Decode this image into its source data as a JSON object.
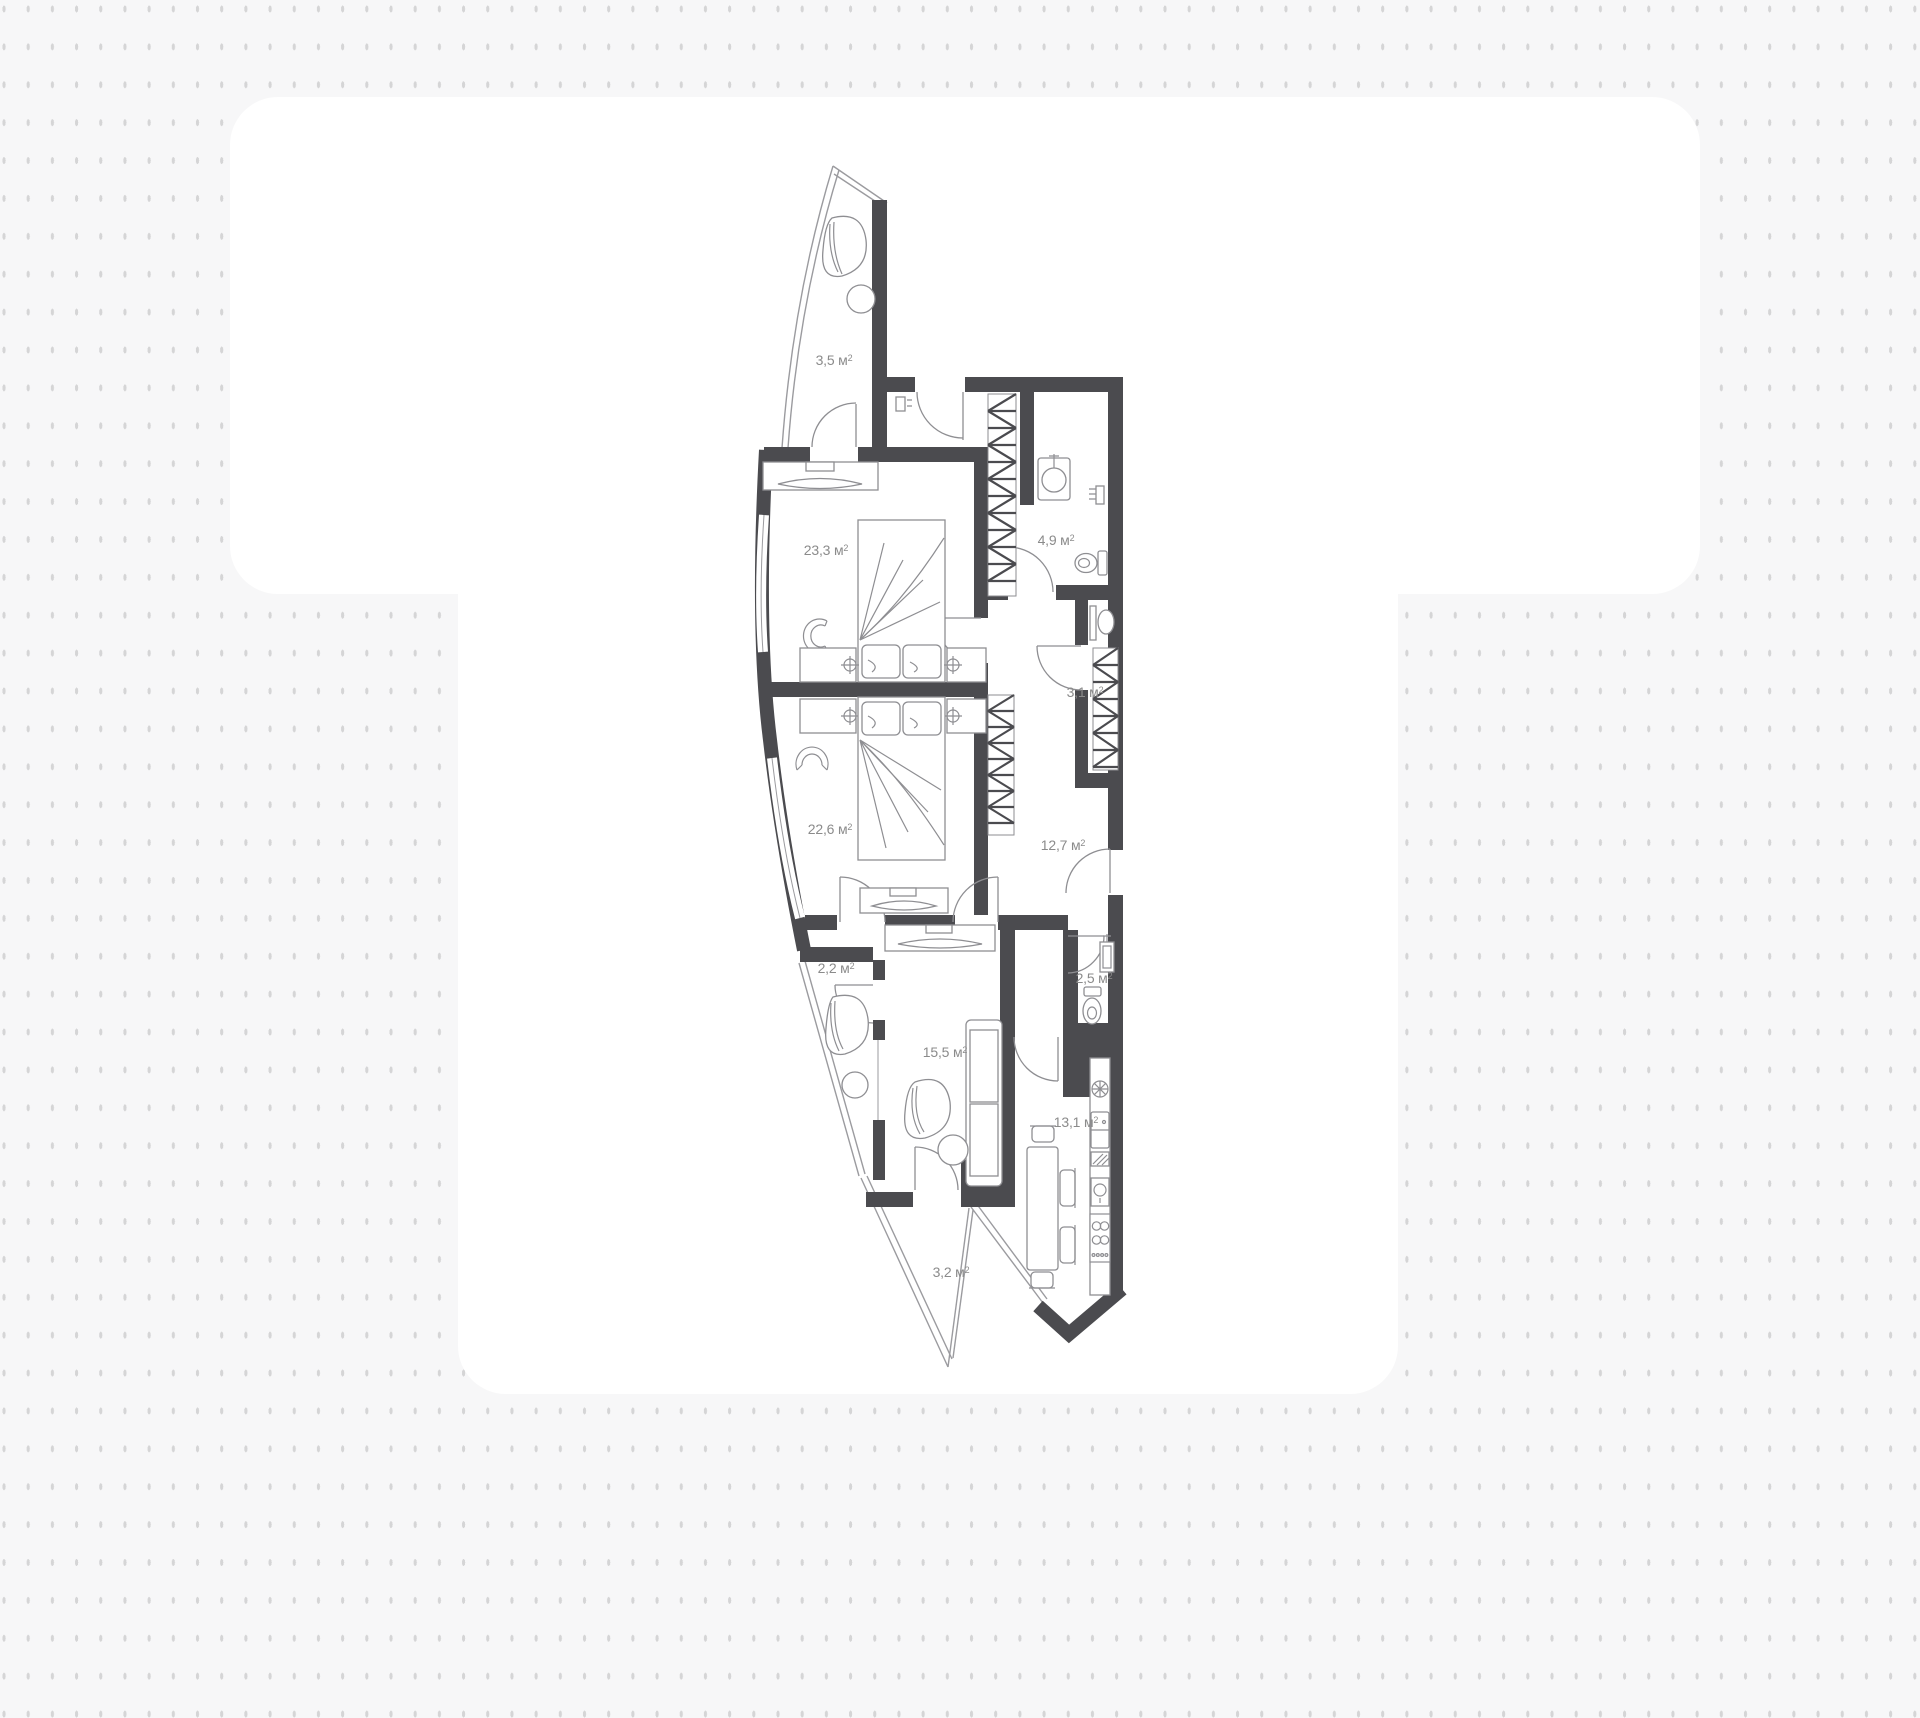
{
  "colors": {
    "background": "#f7f7f8",
    "dots": "#d5d5d6",
    "panel": "#ffffff",
    "walls": "#4b4b4f",
    "furniture": "#8e8e92",
    "glazing": "#9b9b9f",
    "labels": "#8b8b8b"
  },
  "units": {
    "area_unit": "м",
    "area_sup": "2"
  },
  "rooms": [
    {
      "id": "balcony-top",
      "area": "3,5",
      "x": 834,
      "y": 360
    },
    {
      "id": "bedroom-1",
      "area": "23,3",
      "x": 826,
      "y": 550
    },
    {
      "id": "bathroom",
      "area": "4,9",
      "x": 1056,
      "y": 540
    },
    {
      "id": "closet",
      "area": "3,1",
      "x": 1085,
      "y": 692
    },
    {
      "id": "bedroom-2",
      "area": "22,6",
      "x": 830,
      "y": 829
    },
    {
      "id": "hallway",
      "area": "12,7",
      "x": 1063,
      "y": 845
    },
    {
      "id": "balcony-middle",
      "area": "2,2",
      "x": 836,
      "y": 968
    },
    {
      "id": "living-room",
      "area": "15,5",
      "x": 945,
      "y": 1052
    },
    {
      "id": "wc",
      "area": "2,5",
      "x": 1094,
      "y": 978
    },
    {
      "id": "kitchen",
      "area": "13,1",
      "x": 1076,
      "y": 1122
    },
    {
      "id": "balcony-bottom",
      "area": "3,2",
      "x": 951,
      "y": 1272
    }
  ]
}
